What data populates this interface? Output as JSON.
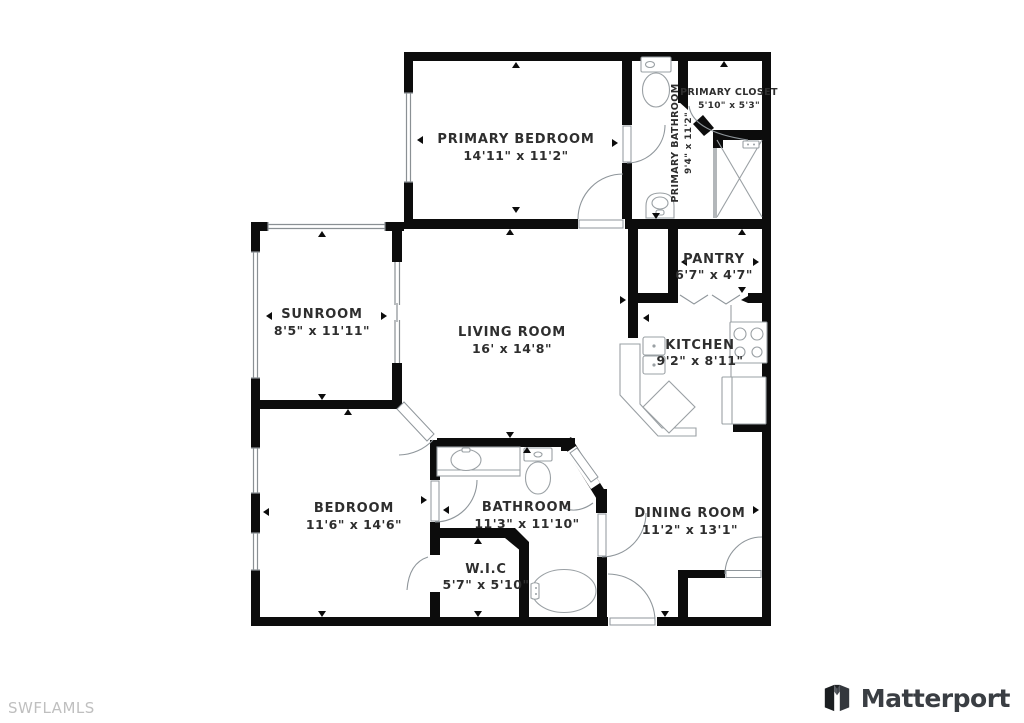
{
  "watermark": "SWFLAMLS",
  "brand": {
    "name": "Matterport"
  },
  "rooms": [
    {
      "id": "primary-bedroom",
      "name": "PRIMARY BEDROOM",
      "dims": "14'11\" x 11'2\""
    },
    {
      "id": "primary-closet",
      "name": "PRIMARY CLOSET",
      "dims": "5'10\" x 5'3\""
    },
    {
      "id": "primary-bathroom",
      "name": "PRIMARY BATHROOM",
      "dims": "9'4\" x 11'2\""
    },
    {
      "id": "pantry",
      "name": "PANTRY",
      "dims": "6'7\" x 4'7\""
    },
    {
      "id": "sunroom",
      "name": "SUNROOM",
      "dims": "8'5\" x 11'11\""
    },
    {
      "id": "living-room",
      "name": "LIVING ROOM",
      "dims": "16' x 14'8\""
    },
    {
      "id": "kitchen",
      "name": "KITCHEN",
      "dims": "9'2\" x 8'11\""
    },
    {
      "id": "bedroom",
      "name": "BEDROOM",
      "dims": "11'6\" x 14'6\""
    },
    {
      "id": "bathroom",
      "name": "BATHROOM",
      "dims": "11'3\" x 11'10\""
    },
    {
      "id": "wic",
      "name": "W.I.C",
      "dims": "5'7\" x 5'10\""
    },
    {
      "id": "dining-room",
      "name": "DINING ROOM",
      "dims": "11'2\" x 13'1\""
    }
  ],
  "colors": {
    "wall": "#0c0c0c",
    "fixture_outline": "#9aa0a4",
    "label_text": "#2e2e2e",
    "watermark_text": "#bfbfbf",
    "brand_text": "#3a3e43"
  }
}
